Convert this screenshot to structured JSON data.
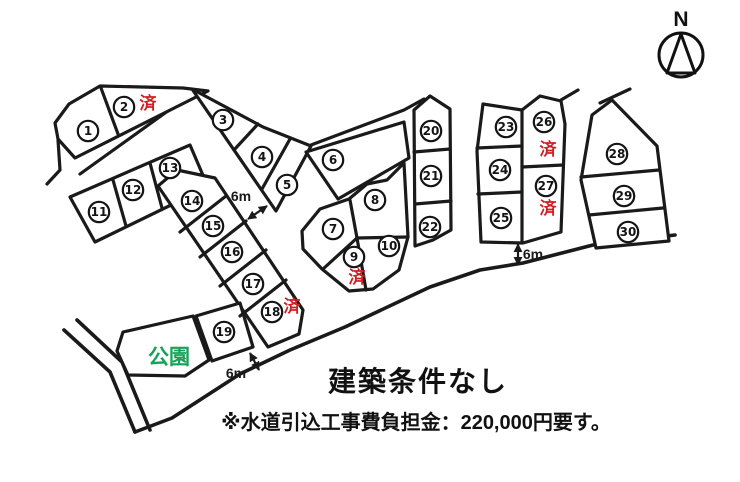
{
  "texts": {
    "title": "建築条件なし",
    "note": "※水道引込工事費負担金：220,000円要す。"
  },
  "north": {
    "label": "N"
  },
  "park": {
    "label": "公園",
    "color": "#17a257"
  },
  "legend": {
    "sold_label": "済",
    "sold_color": "#d01f24"
  },
  "dims": [
    {
      "label": "6m"
    },
    {
      "label": "6m"
    },
    {
      "label": "6m"
    }
  ],
  "lots": [
    {
      "n": "1",
      "x": 88,
      "y": 131
    },
    {
      "n": "2",
      "x": 124,
      "y": 107,
      "sold": true,
      "sold_x": 148,
      "sold_y": 103
    },
    {
      "n": "3",
      "x": 223,
      "y": 120
    },
    {
      "n": "4",
      "x": 262,
      "y": 157
    },
    {
      "n": "5",
      "x": 287,
      "y": 185
    },
    {
      "n": "6",
      "x": 333,
      "y": 160
    },
    {
      "n": "7",
      "x": 333,
      "y": 229
    },
    {
      "n": "8",
      "x": 375,
      "y": 200
    },
    {
      "n": "9",
      "x": 354,
      "y": 257,
      "sold": true,
      "sold_x": 357,
      "sold_y": 277
    },
    {
      "n": "10",
      "x": 389,
      "y": 246
    },
    {
      "n": "11",
      "x": 99,
      "y": 212
    },
    {
      "n": "12",
      "x": 133,
      "y": 190
    },
    {
      "n": "13",
      "x": 170,
      "y": 168
    },
    {
      "n": "14",
      "x": 192,
      "y": 201
    },
    {
      "n": "15",
      "x": 213,
      "y": 226
    },
    {
      "n": "16",
      "x": 232,
      "y": 252
    },
    {
      "n": "17",
      "x": 253,
      "y": 284
    },
    {
      "n": "18",
      "x": 272,
      "y": 312,
      "sold": true,
      "sold_x": 292,
      "sold_y": 306
    },
    {
      "n": "19",
      "x": 224,
      "y": 332
    },
    {
      "n": "20",
      "x": 431,
      "y": 131
    },
    {
      "n": "21",
      "x": 431,
      "y": 176
    },
    {
      "n": "22",
      "x": 430,
      "y": 227
    },
    {
      "n": "23",
      "x": 506,
      "y": 127
    },
    {
      "n": "24",
      "x": 500,
      "y": 170
    },
    {
      "n": "25",
      "x": 501,
      "y": 218
    },
    {
      "n": "26",
      "x": 544,
      "y": 122,
      "sold": true,
      "sold_x": 548,
      "sold_y": 149
    },
    {
      "n": "27",
      "x": 546,
      "y": 186,
      "sold": true,
      "sold_x": 548,
      "sold_y": 208
    },
    {
      "n": "28",
      "x": 617,
      "y": 154
    },
    {
      "n": "29",
      "x": 624,
      "y": 196
    },
    {
      "n": "30",
      "x": 628,
      "y": 232
    }
  ]
}
